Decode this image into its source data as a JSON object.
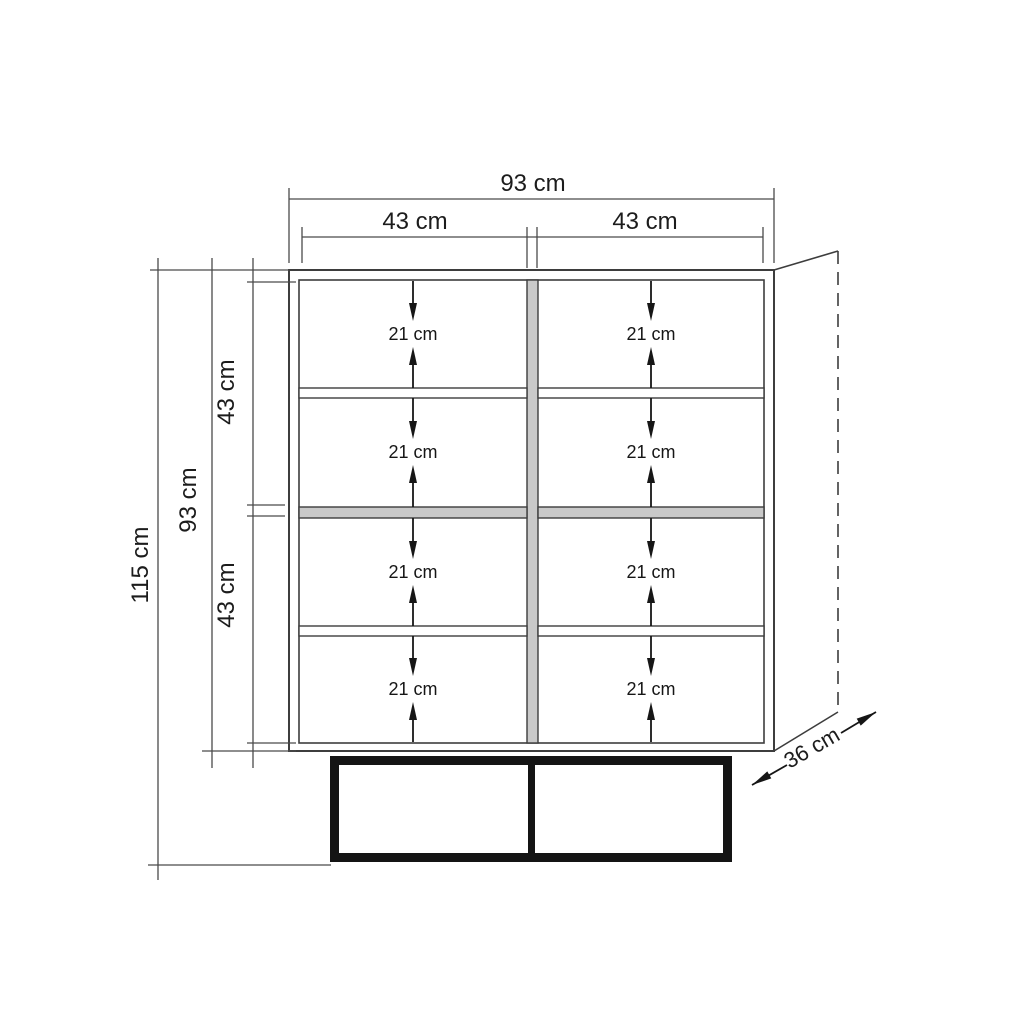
{
  "dimensions": {
    "total_width": "93 cm",
    "column_widths": [
      "43 cm",
      "43 cm"
    ],
    "total_height": "115 cm",
    "body_height": "93 cm",
    "half_heights": [
      "43 cm",
      "43 cm"
    ],
    "depth": "36 cm",
    "compartment_heights": [
      "21 cm",
      "21 cm",
      "21 cm",
      "21 cm",
      "21 cm",
      "21 cm",
      "21 cm",
      "21 cm"
    ]
  },
  "colors": {
    "line": "#3d3d3d",
    "dimension_line": "#4a4a4a",
    "shelf_fill": "#c9c9c9",
    "base_black": "#141414",
    "background": "#ffffff"
  }
}
